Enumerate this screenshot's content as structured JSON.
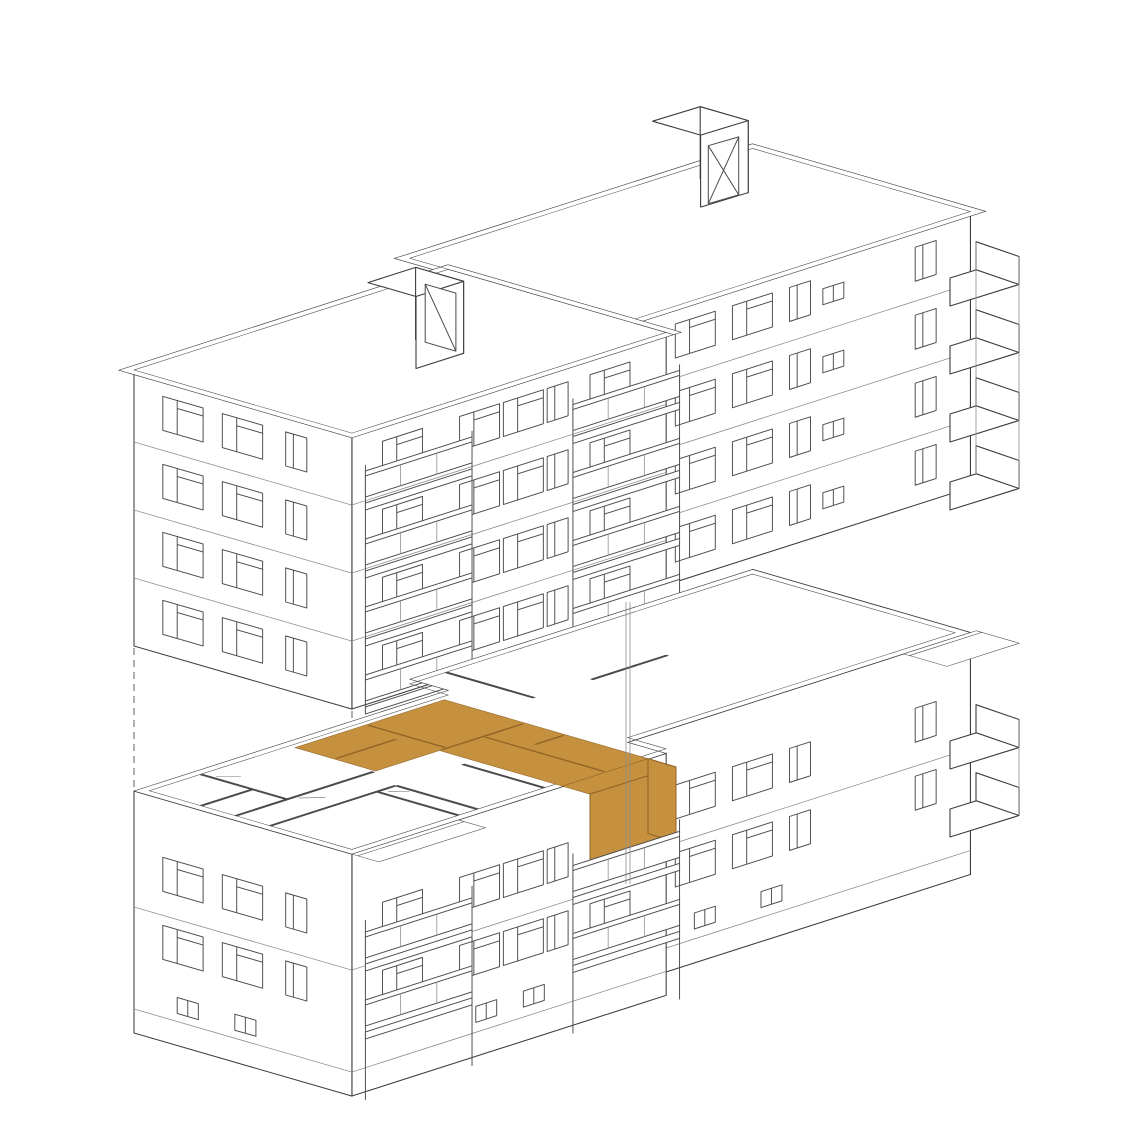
{
  "colors": {
    "highlight": "#C6913F",
    "highlight_shade": "#C08A38",
    "highlight_edge": "#8F6226",
    "line": "#3d3d3d",
    "line_light": "#8c8c8c",
    "dash": "#6f6f6f",
    "background": "#ffffff"
  },
  "diagram": {
    "kind": "exploded axonometric building diagram",
    "upper_block_floors": 4,
    "lower_block_floors": 2,
    "rooftop_bulkheads": 2,
    "recessed_balcony_stacks": 2,
    "corner_balcony_levels_upper": 4,
    "corner_balcony_levels_lower": 2,
    "highlighted_unit": {
      "name": "selected-apartment",
      "shape": "L-shaped",
      "location": "second-floor plan, right wing"
    }
  }
}
